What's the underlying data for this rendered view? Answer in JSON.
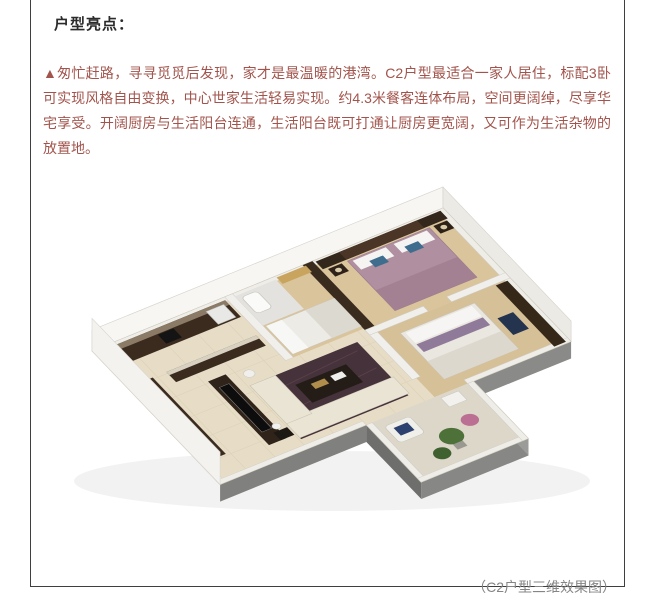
{
  "article": {
    "heading": "户型亮点：",
    "paragraph": "▲匆忙赶路，寻寻觅觅后发现，家才是最温暖的港湾。C2户型最适合一家人居住，标配3卧可实现风格自由变换，中心世家生活轻易实现。约4.3米餐客连体布局，空间更阔绰，尽享华宅享受。开阔厨房与生活阳台连通，生活阳台既可打通让厨房更宽阔，又可作为生活杂物的放置地。",
    "caption": "（C2户型三维效果图）",
    "colors": {
      "heading_text": "#2b2b2b",
      "paragraph_text": "#a2544c",
      "caption_text": "#858585",
      "frame_border": "#3f3f3f",
      "page_background": "#ffffff"
    }
  },
  "figure": {
    "description": "C2户型三维效果图 — 3D isometric cutaway render of apartment: kitchen with dark cabinets, bedroom with gold curtains, master bedroom with mauve bed, living room with TV wall and cream sofa, second bedroom with white bed, balcony with plants and white chair",
    "palette": {
      "outer_wall_white": "#f5f4f0",
      "floor_tile_beige": "#e7ddc6",
      "wood_floor": "#d9c49c",
      "dark_walnut_wall": "#362818",
      "master_bed_mauve": "#b08fa0",
      "gold_curtain": "#c9a45f",
      "rug_burgundy": "#46323a",
      "sofa_cream": "#e9e4d4",
      "navy_accent": "#2c4170",
      "plant_green": "#4d7139",
      "flower_pink": "#bb6f92",
      "platform_gray": "#80807e"
    }
  }
}
